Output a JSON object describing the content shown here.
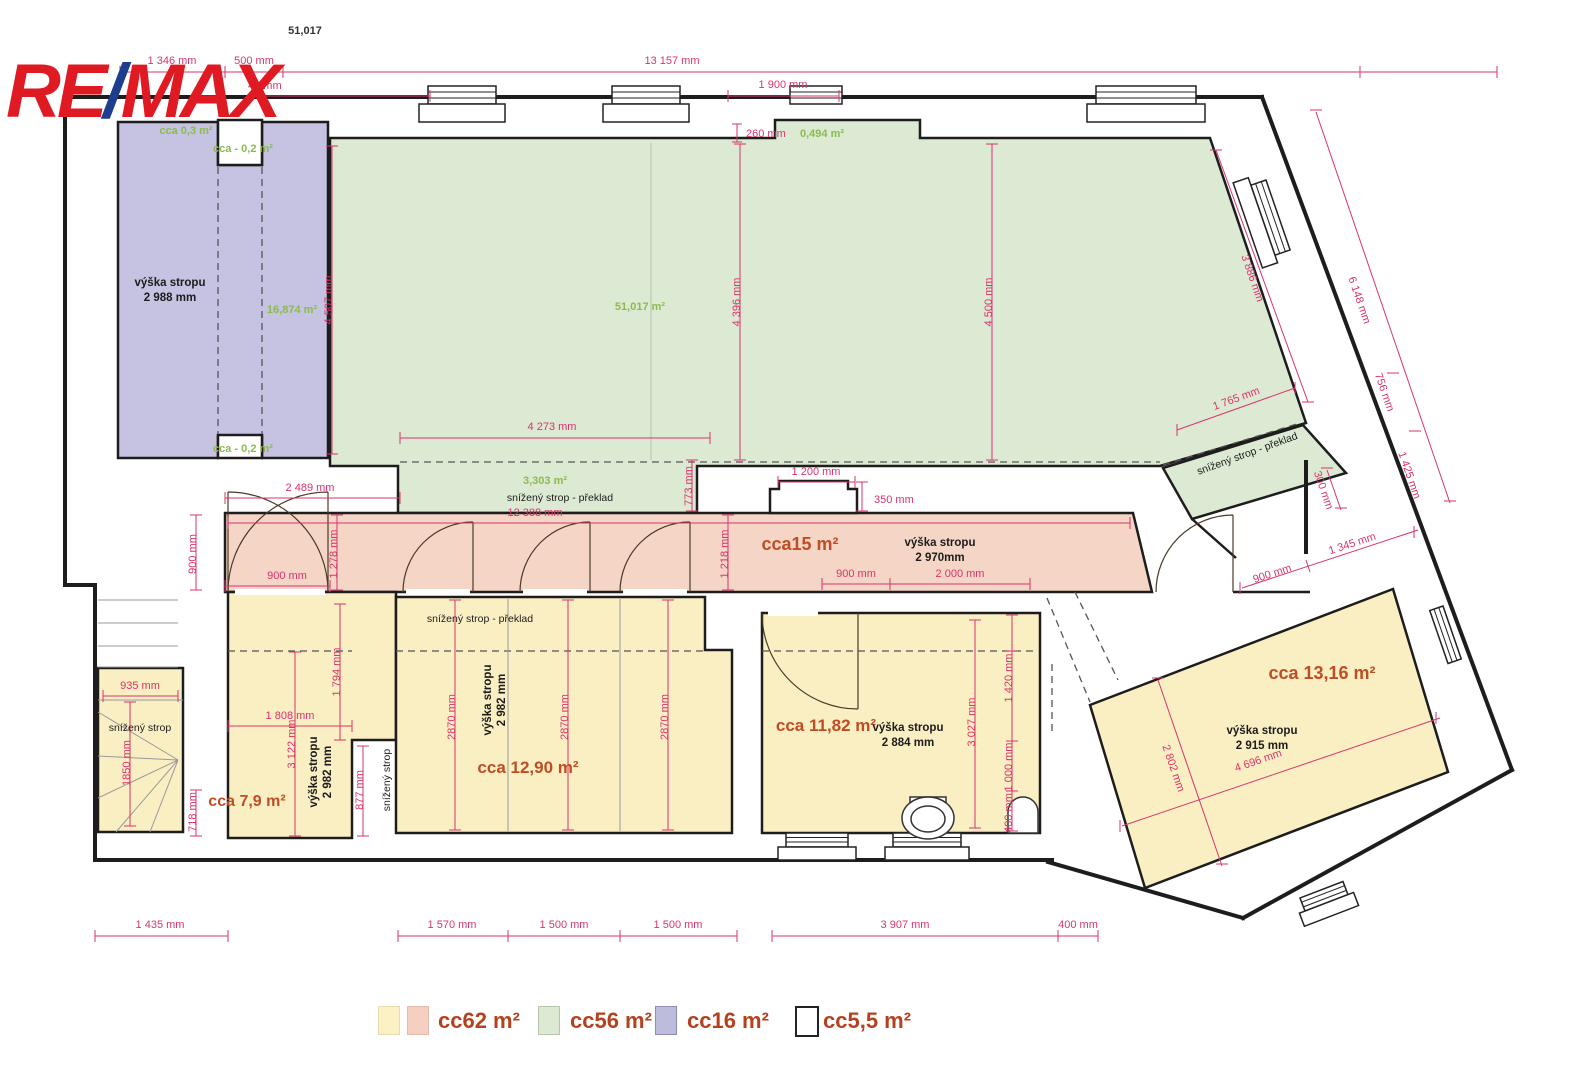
{
  "colors": {
    "dimension_pink": "#d9336e",
    "area_green_text": "#8cba50",
    "room_label_orange": "#bf4d24",
    "legend_text": "#b5421f",
    "fill_yellow": "#faeec3",
    "fill_pink": "#f5d5c5",
    "fill_green": "#dcead3",
    "fill_blue": "#c5c3e1",
    "logo_red": "#e01a22",
    "logo_blue": "#1d3d8f"
  },
  "logo": {
    "re": "RE",
    "slash": "/",
    "max": "MAX"
  },
  "header": {
    "plan_number": "51,017"
  },
  "areas": {
    "a_blue_top": "cca 0,3 m²",
    "a_blue_n1": "cca - 0,2 m²",
    "a_blue_n2": "cca - 0,2 m²",
    "a_blue": "16,874 m²",
    "a_green": "51,017 m²",
    "a_green_niche": "0,494 m²",
    "a_green_strip": "3,303 m²",
    "a_corridor": "cca15 m²",
    "a_79": "cca 7,9 m²",
    "a_1290": "cca 12,90 m²",
    "a_1182": "cca 11,82 m²",
    "a_1316": "cca 13,16 m²"
  },
  "heights": {
    "h_blue_1": "výška stropu",
    "h_blue_2": "2 988 mm",
    "h_cor_1": "výška stropu",
    "h_cor_2": "2 970mm",
    "h_left_1": "výška stropu",
    "h_left_2": "2 982 mm",
    "h_center_1": "výška stropu",
    "h_center_2": "2 982 mm",
    "h_1182_1": "výška stropu",
    "h_1182_2": "2 884 mm",
    "h_1316_1": "výška stropu",
    "h_1316_2": "2 915 mm"
  },
  "notes": {
    "n_strip": "snížený strop - překlad",
    "n_right": "snížený strop - překlad",
    "n_center": "snížený strop - překlad",
    "n_stairs": "snížený strop",
    "n_vert": "snížený strop"
  },
  "dims": {
    "top_1346": "1 346 mm",
    "top_500": "500 mm",
    "top_44": "44 mm",
    "top_13157": "13 157 mm",
    "top_1900": "1 900 mm",
    "niche_260": "260 mm",
    "v4507": "4 507 mm",
    "v4396": "4 396 mm",
    "v4500": "4 500 mm",
    "d3886": "3 886 mm",
    "d1765": "1 765 mm",
    "h4273": "4 273 mm",
    "v773": "773 mm",
    "d6148": "6 148 mm",
    "d756": "756 mm",
    "d1425": "1 425 mm",
    "v300": "300 mm",
    "h2489": "2 489 mm",
    "v900L": "900 mm",
    "h12388": "12 388 mm",
    "v1278": "1 278 mm",
    "h900door": "900 mm",
    "v1218": "1 218 mm",
    "h900c": "900 mm",
    "h2000": "2 000 mm",
    "h1200": "1 200 mm",
    "v350": "350 mm",
    "d900R": "900 mm",
    "d1345": "1 345 mm",
    "h935": "935 mm",
    "v1850": "1850 mm",
    "v718": "718 mm",
    "h1808": "1 808 mm",
    "v1794": "1 794 mm",
    "v3122": "3 122 mm",
    "v877": "877 mm",
    "v2870a": "2870 mm",
    "v2870b": "2870 mm",
    "v2870c": "2870 mm",
    "v3027": "3 027 mm",
    "v1420": "1 420 mm",
    "v1000": "1 000 mm",
    "v400": "400 mm",
    "d4696": "4 696 mm",
    "d2802": "2 802 mm",
    "b1435": "1 435 mm",
    "b1570": "1 570 mm",
    "b1500a": "1 500 mm",
    "b1500b": "1 500 mm",
    "b3907": "3 907 mm",
    "b400": "400 mm"
  },
  "legend": {
    "items": [
      {
        "label": "cc62 m²",
        "swatches": [
          "#fcf0c5",
          "#f5cfc0"
        ]
      },
      {
        "label": "cc56 m²",
        "swatches": [
          "#dcead3"
        ]
      },
      {
        "label": "cc16 m²",
        "swatches": [
          "#bebcdd"
        ]
      },
      {
        "label": "cc5,5 m²",
        "swatches": [
          "#ffffff"
        ]
      }
    ]
  }
}
